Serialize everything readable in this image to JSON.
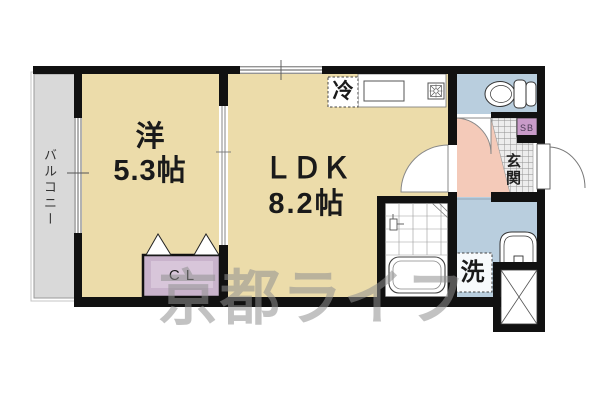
{
  "plan": {
    "title": "1K apartment floor plan",
    "balcony_label": "バルコニー",
    "western_room": {
      "name": "洋",
      "size": "5.3帖"
    },
    "ldk": {
      "name": "ＬＤＫ",
      "size": "8.2帖"
    },
    "refrigerator_label": "冷",
    "washer_label": "洗",
    "closet_label": "CL",
    "shoebox_label": "SB",
    "entrance_label": "玄関",
    "watermark": "京都ライフ"
  },
  "colors": {
    "room_tan": "#ecdcaa",
    "balcony_gray": "#d9d9d9",
    "water_blue": "#b9cede",
    "hall_pink": "#f4cab9",
    "closet_lavender": "#c9b3cc",
    "shoebox_purple": "#c99bc9",
    "wall_black": "#111111",
    "watermark_gray": "#8f8f8f"
  }
}
